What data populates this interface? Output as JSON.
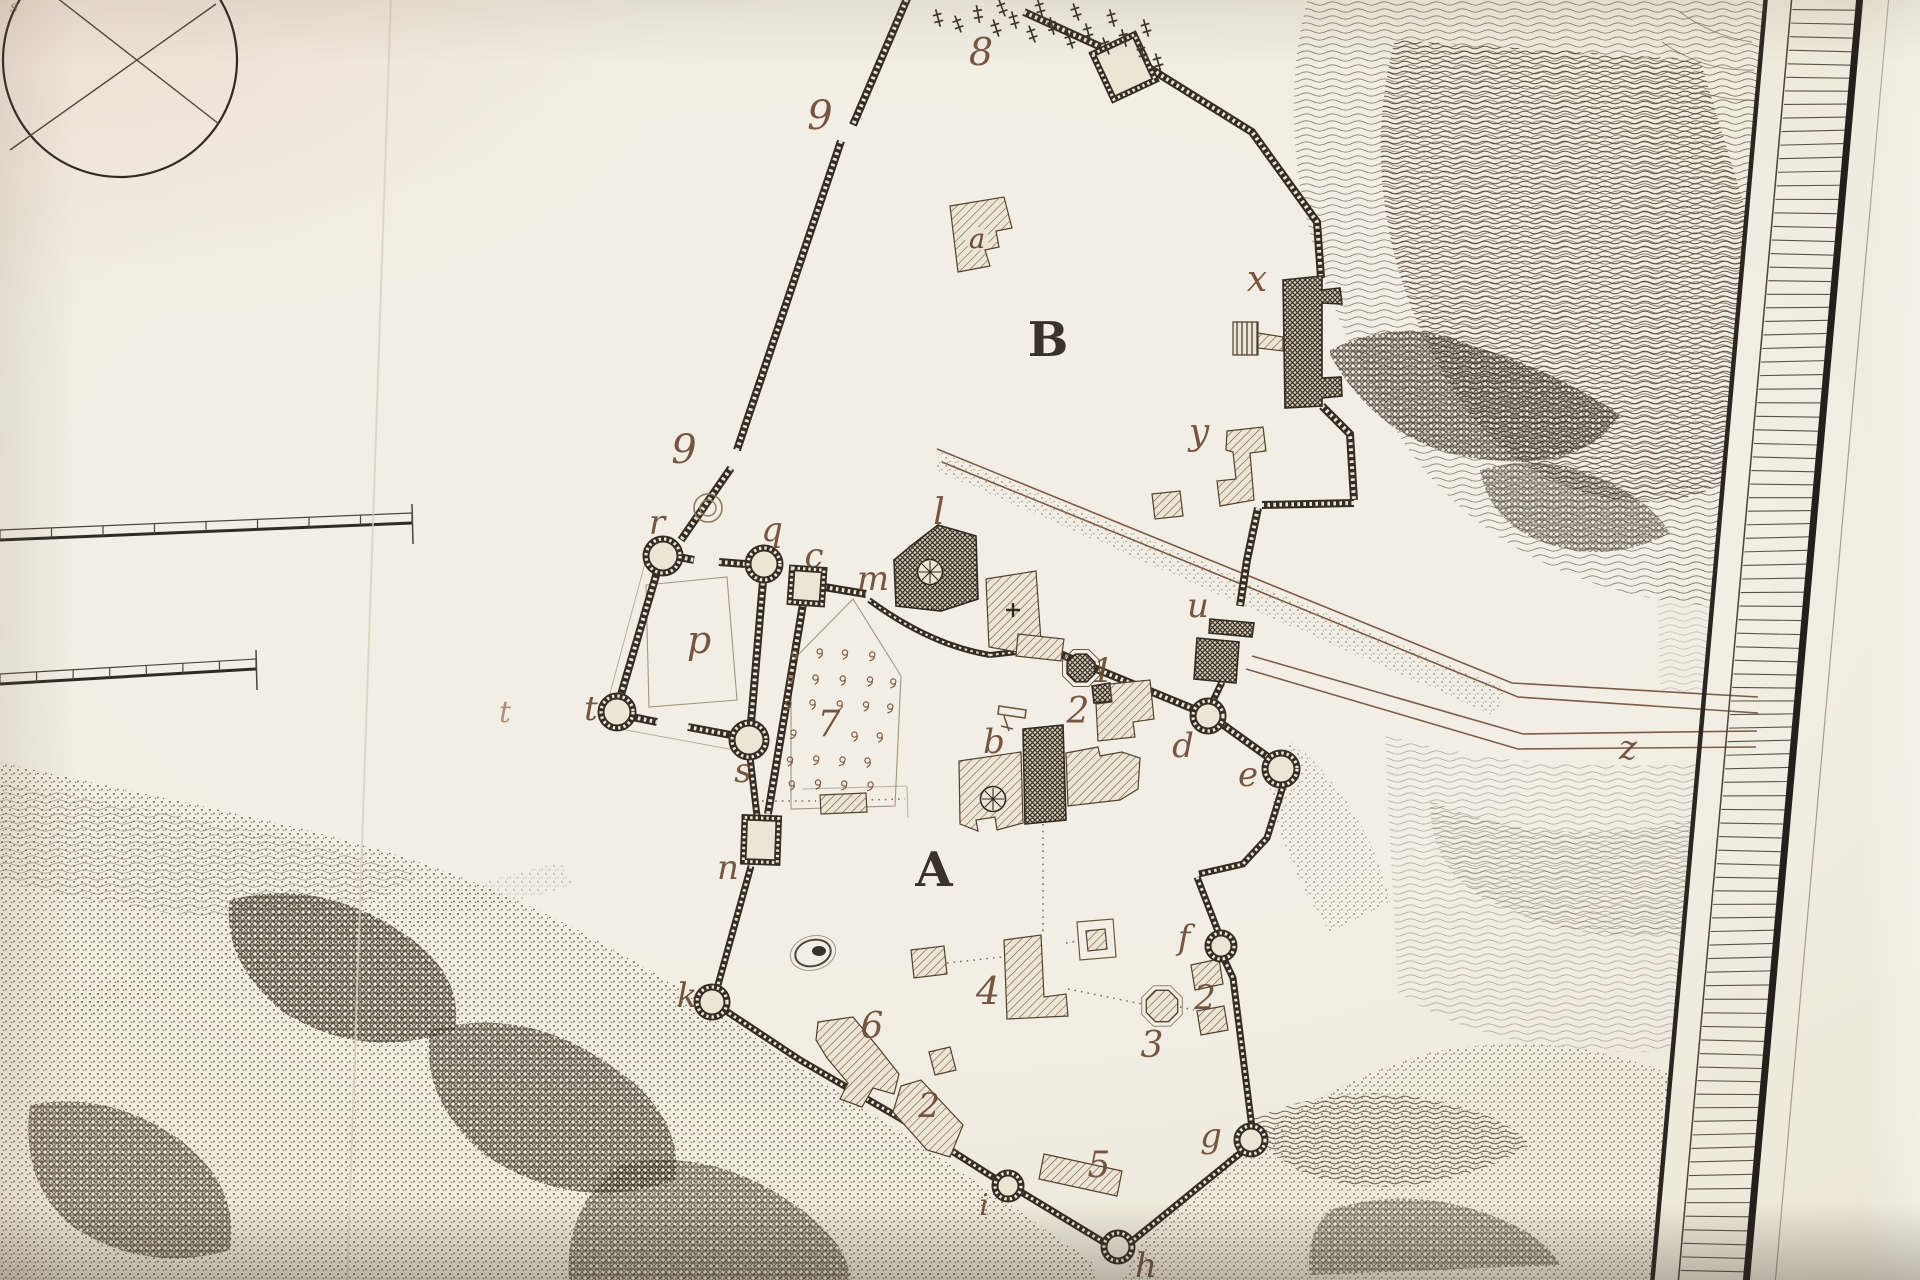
{
  "page": {
    "title": "Engraved plan of a hill-top fortress (antique plate photograph)"
  },
  "palette": {
    "paper": "#efe9dc",
    "ink_dark": "#3a332b",
    "ink_wall": "#352d24",
    "label_sepia": "#6b4a36",
    "terrain_line": "#5d4e3e",
    "road_line": "#7a5c49",
    "border_black": "#241f1a"
  },
  "map": {
    "enclosure_labels": [
      {
        "t": "B",
        "x": 1048,
        "y": 356,
        "s": 48,
        "k": "cap"
      },
      {
        "t": "A",
        "x": 934,
        "y": 886,
        "s": 48,
        "k": "cap"
      }
    ],
    "letter_labels": [
      {
        "t": "a",
        "x": 977,
        "y": 248,
        "s": 27,
        "k": "let"
      },
      {
        "t": "b",
        "x": 994,
        "y": 753,
        "s": 34,
        "k": "let"
      },
      {
        "t": "c",
        "x": 814,
        "y": 567,
        "s": 34,
        "k": "let"
      },
      {
        "t": "d",
        "x": 1183,
        "y": 757,
        "s": 34,
        "k": "let"
      },
      {
        "t": "e",
        "x": 1248,
        "y": 786,
        "s": 34,
        "k": "let"
      },
      {
        "t": "f",
        "x": 1184,
        "y": 949,
        "s": 34,
        "k": "let"
      },
      {
        "t": "g",
        "x": 1211,
        "y": 1147,
        "s": 34,
        "k": "let"
      },
      {
        "t": "h",
        "x": 1146,
        "y": 1277,
        "s": 34,
        "k": "let"
      },
      {
        "t": "i",
        "x": 984,
        "y": 1215,
        "s": 30,
        "k": "let"
      },
      {
        "t": "k",
        "x": 687,
        "y": 1007,
        "s": 34,
        "k": "let"
      },
      {
        "t": "l",
        "x": 939,
        "y": 524,
        "s": 36,
        "k": "let"
      },
      {
        "t": "m",
        "x": 873,
        "y": 590,
        "s": 34,
        "k": "let"
      },
      {
        "t": "n",
        "x": 728,
        "y": 879,
        "s": 34,
        "k": "let"
      },
      {
        "t": "p",
        "x": 699,
        "y": 653,
        "s": 38,
        "k": "let"
      },
      {
        "t": "q",
        "x": 772,
        "y": 541,
        "s": 34,
        "k": "let"
      },
      {
        "t": "r",
        "x": 657,
        "y": 534,
        "s": 34,
        "k": "let"
      },
      {
        "t": "s",
        "x": 743,
        "y": 782,
        "s": 34,
        "k": "let"
      },
      {
        "t": "t",
        "x": 591,
        "y": 720,
        "s": 34,
        "k": "let"
      },
      {
        "t": "u",
        "x": 1198,
        "y": 617,
        "s": 34,
        "k": "let"
      },
      {
        "t": "x",
        "x": 1257,
        "y": 291,
        "s": 36,
        "k": "let"
      },
      {
        "t": "y",
        "x": 1199,
        "y": 444,
        "s": 36,
        "k": "let"
      },
      {
        "t": "z",
        "x": 1628,
        "y": 759,
        "s": 34,
        "k": "let"
      }
    ],
    "number_labels": [
      {
        "t": "1",
        "x": 1103,
        "y": 682,
        "s": 34,
        "k": "num"
      },
      {
        "t": "2",
        "x": 1078,
        "y": 723,
        "s": 36,
        "k": "num"
      },
      {
        "t": "2",
        "x": 1205,
        "y": 1009,
        "s": 34,
        "k": "num"
      },
      {
        "t": "2",
        "x": 929,
        "y": 1117,
        "s": 34,
        "k": "num"
      },
      {
        "t": "3",
        "x": 1152,
        "y": 1057,
        "s": 36,
        "k": "num"
      },
      {
        "t": "4",
        "x": 988,
        "y": 1004,
        "s": 38,
        "k": "num"
      },
      {
        "t": "5",
        "x": 1099,
        "y": 1177,
        "s": 36,
        "k": "num"
      },
      {
        "t": "6",
        "x": 872,
        "y": 1038,
        "s": 36,
        "k": "num"
      },
      {
        "t": "7",
        "x": 829,
        "y": 736,
        "s": 36,
        "k": "num"
      },
      {
        "t": "8",
        "x": 981,
        "y": 65,
        "s": 38,
        "k": "num"
      },
      {
        "t": "9",
        "x": 820,
        "y": 129,
        "s": 40,
        "k": "num"
      },
      {
        "t": "9",
        "x": 684,
        "y": 463,
        "s": 40,
        "k": "num"
      }
    ],
    "stray_mark": {
      "t": "t",
      "x": 505,
      "y": 722,
      "s": 30,
      "k": "stray"
    },
    "corner_scribble": {
      "t": "s",
      "x": 14,
      "y": 12,
      "s": 16,
      "k": "stray"
    },
    "tent_symbols": [
      [
        795,
        656
      ],
      [
        820,
        654
      ],
      [
        845,
        655
      ],
      [
        872,
        657
      ],
      [
        790,
        681
      ],
      [
        816,
        680
      ],
      [
        843,
        681
      ],
      [
        870,
        682
      ],
      [
        893,
        684
      ],
      [
        788,
        706
      ],
      [
        813,
        705
      ],
      [
        840,
        706
      ],
      [
        866,
        707
      ],
      [
        890,
        709
      ],
      [
        793,
        735
      ],
      [
        855,
        737
      ],
      [
        880,
        738
      ],
      [
        790,
        762
      ],
      [
        816,
        761
      ],
      [
        842,
        762
      ],
      [
        868,
        763
      ],
      [
        792,
        786
      ],
      [
        818,
        785
      ],
      [
        844,
        786
      ],
      [
        870,
        787
      ]
    ],
    "cheval_marks": [
      [
        938,
        18,
        -15
      ],
      [
        958,
        24,
        -20
      ],
      [
        978,
        14,
        -10
      ],
      [
        996,
        28,
        -18
      ],
      [
        1014,
        20,
        -15
      ],
      [
        1032,
        34,
        -20
      ],
      [
        1052,
        26,
        -12
      ],
      [
        1070,
        40,
        -18
      ],
      [
        1088,
        32,
        -15
      ],
      [
        1106,
        46,
        -20
      ],
      [
        1124,
        38,
        -14
      ],
      [
        1142,
        52,
        -18
      ],
      [
        1158,
        62,
        -16
      ],
      [
        1002,
        8,
        -20
      ],
      [
        1040,
        8,
        -15
      ],
      [
        1076,
        12,
        -18
      ],
      [
        1112,
        18,
        -15
      ],
      [
        1146,
        28,
        -16
      ]
    ],
    "scale_bars": [
      {
        "divisions": 8,
        "x1": 0,
        "y1": 540,
        "x2": 412,
        "y2": 523
      },
      {
        "divisions": 7,
        "x1": 0,
        "y1": 684,
        "x2": 256,
        "y2": 669
      }
    ],
    "border": {
      "rung_count": 96
    }
  }
}
